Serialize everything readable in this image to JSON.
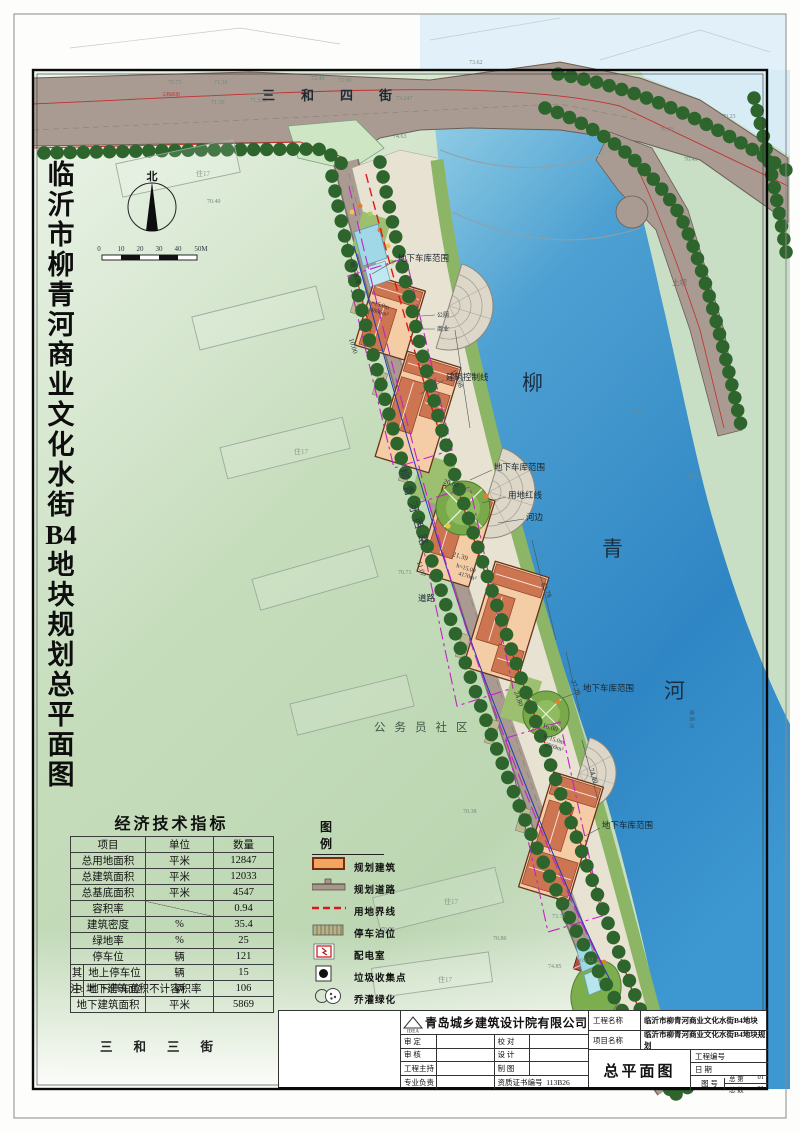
{
  "colors": {
    "river": "#3a8fc9",
    "road": "#a99b92",
    "building": "#f4cda6",
    "roof": "#cd7450",
    "tree": "#2d652d",
    "boundary_red": "#e01616",
    "garage_magenta": "#c324c3",
    "blue_line": "#2236c0",
    "land_green": "#c2dbba"
  },
  "sheet": {
    "vertical_title": "临沂市柳青河商业文化水街B4地块规划总平面图",
    "north": "北",
    "scale": [
      "0",
      "10",
      "20",
      "30",
      "40",
      "50M"
    ]
  },
  "map": {
    "road_top": "三和四街",
    "road_top_tiny": "三和四街",
    "road_bottom": "三和三街",
    "road_west": "柳青河西路",
    "river": [
      "柳",
      "青",
      "河"
    ],
    "river_small": "柳青河",
    "community": "公务员社区",
    "dam": "土坝",
    "ghost": "住17",
    "labels": {
      "garage": "地下车库范围",
      "garage_short": "地下车库",
      "control": "建筑控制线",
      "redline": "用地红线",
      "riverside": "河边",
      "road": "道路",
      "wc": "公厕",
      "biz": "商业"
    },
    "annots": [
      {
        "h": "h=15.0m",
        "a": "4866m²"
      },
      {
        "h": "h=15.00",
        "a": "4170m²"
      },
      {
        "h": "h=15.0m",
        "a": "2969m²"
      }
    ],
    "dims": [
      "105.98",
      "82.78",
      "27.29",
      "74.40",
      "20.80",
      "21.39",
      "16.00",
      "24.80",
      "10.00",
      "11.07"
    ],
    "elev": [
      "70.73",
      "71.36",
      "72.48",
      "72.99",
      "71.532",
      "73.247",
      "71.30",
      "74.63",
      "73.62",
      "70.23",
      "70.70",
      "70.49",
      "70.40",
      "70.76",
      "70.86",
      "73.77",
      "74.85",
      "69.12",
      "70.71",
      "70.38",
      "67.37",
      "68.42"
    ]
  },
  "table": {
    "title": "经济技术指标",
    "headers": [
      "项目",
      "单位",
      "数量"
    ],
    "rows": [
      {
        "group": "",
        "item": "总用地面积",
        "unit": "平米",
        "value": "12847"
      },
      {
        "group": "",
        "item": "总建筑面积",
        "unit": "平米",
        "value": "12033"
      },
      {
        "group": "",
        "item": "总基底面积",
        "unit": "平米",
        "value": "4547"
      },
      {
        "group": "",
        "item": "容积率",
        "unit": "",
        "value": "0.94"
      },
      {
        "group": "",
        "item": "建筑密度",
        "unit": "%",
        "value": "35.4"
      },
      {
        "group": "",
        "item": "绿地率",
        "unit": "%",
        "value": "25"
      },
      {
        "group": "",
        "item": "停车位",
        "unit": "辆",
        "value": "121"
      },
      {
        "group": "其",
        "item": "地上停车位",
        "unit": "辆",
        "value": "15"
      },
      {
        "group": "中",
        "item": "地下停车位",
        "unit": "辆",
        "value": "106"
      },
      {
        "group": "",
        "item": "地下建筑面积",
        "unit": "平米",
        "value": "5869"
      }
    ],
    "note": "注: 地下建筑面积不计容积率"
  },
  "legend": {
    "title": "图例",
    "items": [
      {
        "label": "规划建筑"
      },
      {
        "label": "规划道路"
      },
      {
        "label": "用地界线"
      },
      {
        "label": "停车泊位"
      },
      {
        "label": "配电室"
      },
      {
        "label": "垃圾收集点"
      },
      {
        "label": "乔灌绿化"
      }
    ]
  },
  "titleblock": {
    "company": "青岛城乡建筑设计院有限公司",
    "logo": "IDEA",
    "rows": {
      "r1l": "审 定",
      "r1r": "校 对",
      "r2l": "审 核",
      "r2r": "设 计",
      "r3l": "工程主持",
      "r3r": "制 图",
      "r4l": "专业负责",
      "r4r": "资质证书编号",
      "cert_no": "113B26"
    },
    "project_label": "工程名称",
    "project": "临沂市柳青河商业文化水街B4地块",
    "item_label": "项目名称",
    "item": "临沂市柳青河商业文化水街B4地块规划",
    "drawing": "总平面图",
    "no_label": "工程编号",
    "date_label": "日 期",
    "fig_label": "图 号",
    "zd_label": "总 第",
    "zd": "01",
    "zs_label": "总 数",
    "zs": "01"
  }
}
